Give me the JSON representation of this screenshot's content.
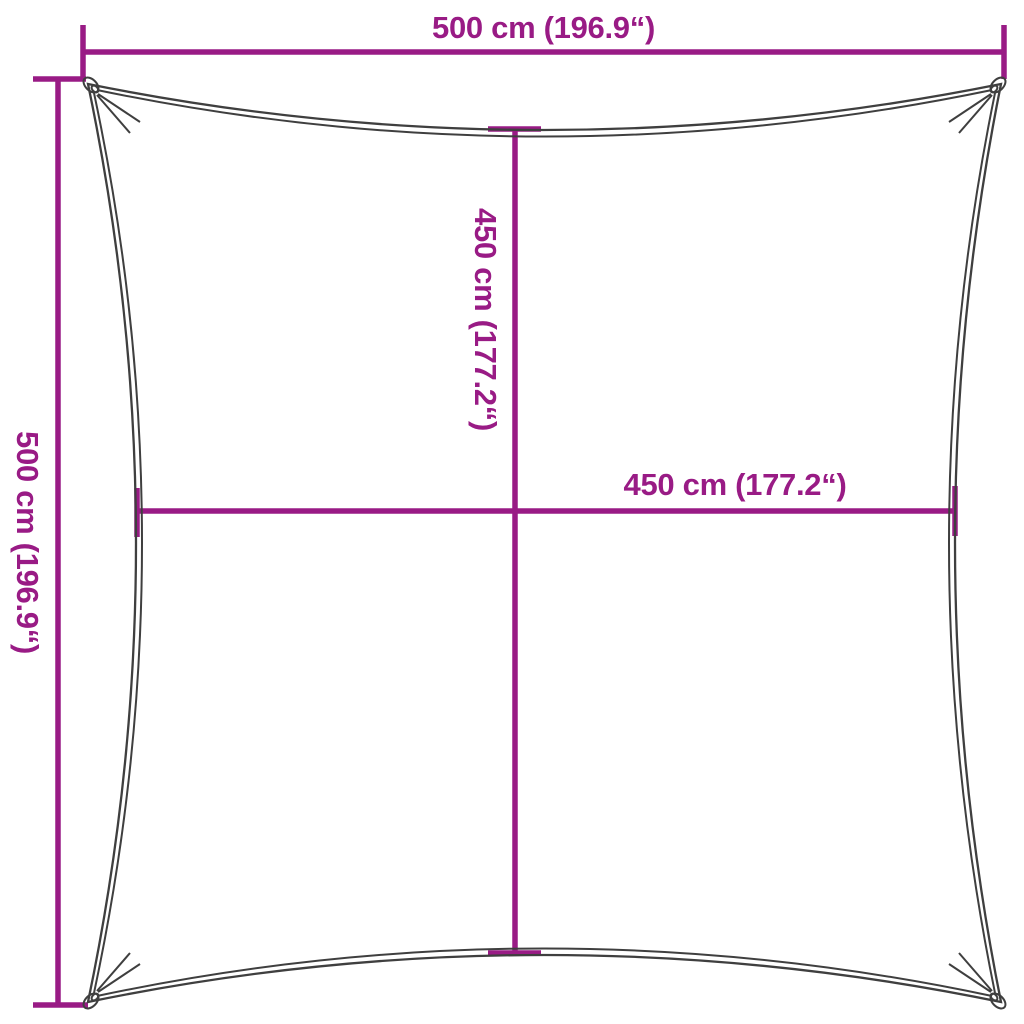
{
  "colors": {
    "dimension": "#991b85",
    "outline": "#3f3f3f",
    "background": "#ffffff"
  },
  "diagram": {
    "kind": "shade-sail-dimension-diagram",
    "shape": "square-with-concave-edges"
  },
  "dimensions": {
    "top": {
      "label": "500 cm (196.9“)",
      "cm": 500,
      "inches": 196.9
    },
    "left": {
      "label": "500 cm (196.9“)",
      "cm": 500,
      "inches": 196.9
    },
    "inner_vertical": {
      "label": "450 cm (177.2“)",
      "cm": 450,
      "inches": 177.2
    },
    "inner_horizontal": {
      "label": "450 cm (177.2“)",
      "cm": 450,
      "inches": 177.2
    }
  }
}
